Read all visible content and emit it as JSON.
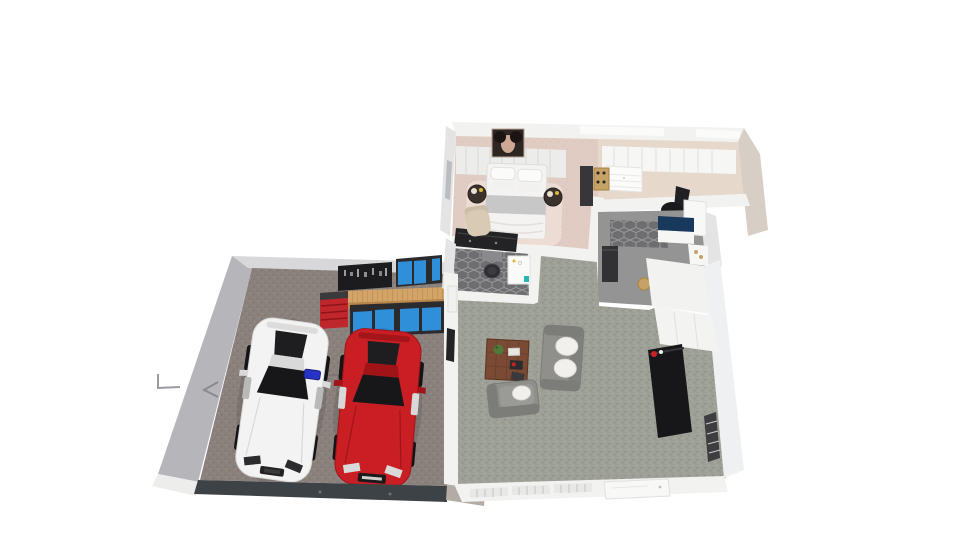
{
  "scene": {
    "title": "3D floor plan render - house with garage, living room, bathroom, entry and master suite",
    "background": "#ffffff"
  },
  "rooms": [
    {
      "name": "garage",
      "floor": "#8a817c"
    },
    {
      "name": "master-bedroom",
      "floor": "#e0ccc2"
    },
    {
      "name": "walk-in-closet",
      "floor": "#e6d9cc"
    },
    {
      "name": "bathroom",
      "floor": "#6e6e70"
    },
    {
      "name": "entry-hall",
      "floor": "#949494"
    },
    {
      "name": "living-room",
      "floor": "#9da096"
    }
  ],
  "palette": {
    "wall_white": "#f2f2f0",
    "wall_light": "#e4e4e4",
    "wall_gray": "#b6b6ba",
    "wall_top_gray": "#d8d8da",
    "wall_greige": "#d7cec5",
    "garage_door": "#3d4247",
    "pavement": "#b3aca4",
    "carpet_speck_dark": "#8b8e83",
    "carpet_speck_light": "#b3ac9c",
    "concrete_speck_dark": "#7b736e",
    "concrete_speck_light": "#978f89",
    "bed_speck": "#d7c2b7",
    "bedroom_rug": "#ecdcd3",
    "bath_grout": "#98989a",
    "workbench_wood": "#d2a468",
    "workbench_wood_dark": "#b9854b",
    "cabinet_blue": "#2f8fd8",
    "cabinet_dark": "#2b2b2e",
    "tool_cart_red": "#c0272c",
    "pegboard_black": "#1c1c1e",
    "car_white": "#f3f3f3",
    "car_white_shade": "#d9d9d9",
    "car_red": "#c81e24",
    "car_red_shade": "#a01418",
    "car_glass": "#17171a",
    "tire_black": "#141416",
    "creeper_blue": "#2633c4",
    "sofa_gray": "#8f8f8c",
    "sofa_gray_dark": "#7c7c79",
    "pillow_white": "#f1f0ec",
    "coffee_table_brown": "#7a4a34",
    "tv_black": "#17171a",
    "bed_white": "#f4f3f1",
    "bed_throw_gray": "#c7c7c7",
    "nightstand_dark": "#3b322e",
    "dresser_black": "#232326",
    "chair_beige": "#d8cab3",
    "wood_light": "#c5a266",
    "navy_counter": "#18395c",
    "appliance_dark": "#323234",
    "plant_green": "#4f7a3a",
    "accent_teal": "#2ab5b5",
    "window_dark": "#3e3e40",
    "toilet_seat": "#2e2e32",
    "office_chair_black": "#1a1a1c",
    "decor_red": "#cc2222",
    "flower_yellow": "#d8b838"
  }
}
